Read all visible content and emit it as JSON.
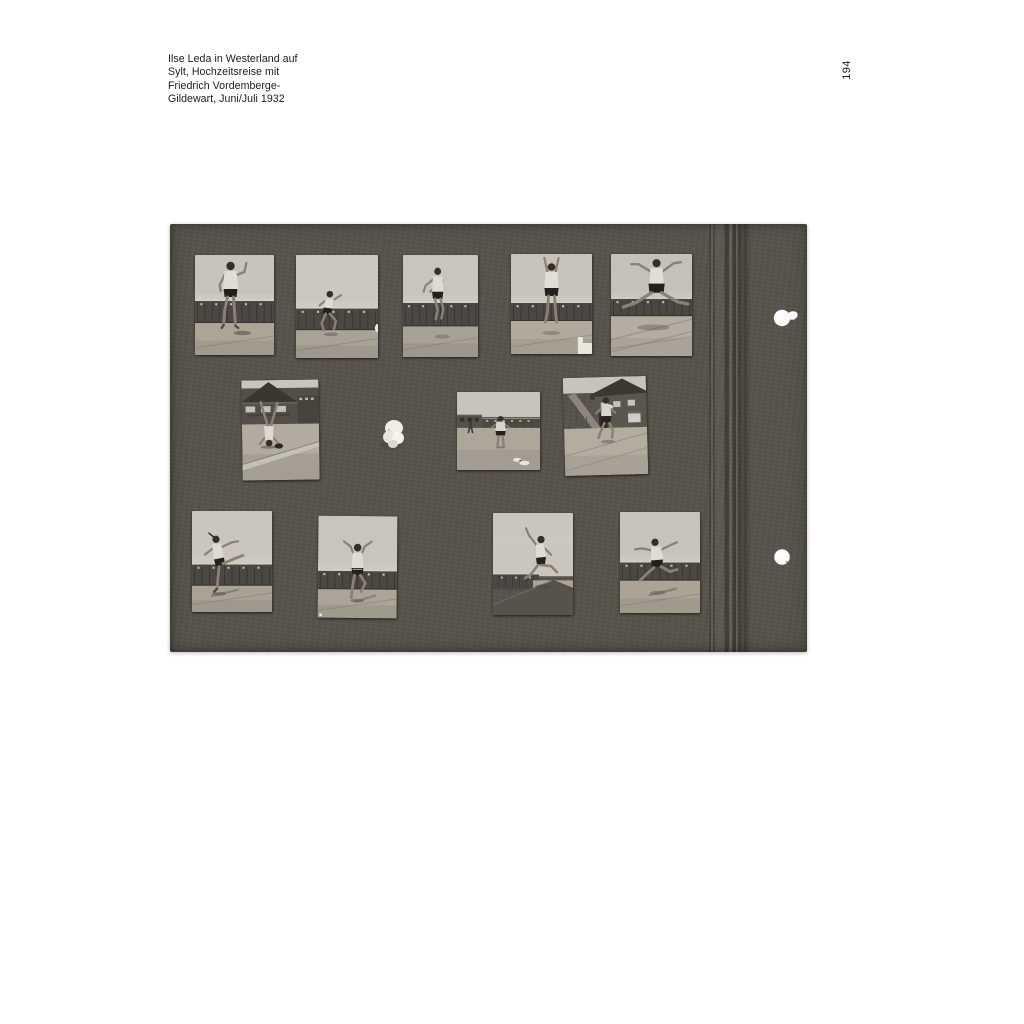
{
  "page": {
    "background": "#ffffff",
    "number": "194"
  },
  "caption": {
    "lines": [
      "Ilse Leda in Westerland auf",
      "Sylt, Hochzeitsreise mit",
      "Friedrich Vordemberge-",
      "Gildewart, Juni/Juli 1932"
    ]
  },
  "album": {
    "board": {
      "x": 170,
      "y": 224,
      "width": 637,
      "height": 428,
      "color": "#57534b"
    },
    "binding": {
      "x": 705,
      "width": 48
    },
    "punch_holes": [
      {
        "cx": 782,
        "cy": 318,
        "r": 8.2,
        "torn_tab": true
      },
      {
        "cx": 782,
        "cy": 557,
        "r": 7.8,
        "torn_tab": false
      }
    ],
    "glue_blob": {
      "cx": 394,
      "cy": 432
    },
    "photos": [
      {
        "id": "1",
        "x": 195,
        "y": 255,
        "width": 79,
        "height": 100,
        "rotation": 0,
        "scene": "cabins",
        "pose": "stand-arm-raised",
        "band": [
          46,
          68
        ],
        "sky": "#c8c4bc",
        "ground_color": "#aca596",
        "description": "Gymnastic pose, one arm raised, beach cabins behind"
      },
      {
        "id": "2",
        "x": 296,
        "y": 255,
        "width": 82,
        "height": 103,
        "rotation": 0,
        "scene": "cabins",
        "pose": "leap",
        "band": [
          52,
          73
        ],
        "sky": "#ccc8c0",
        "ground_color": "#a9a296",
        "description": "Distant leap in front of cabin row"
      },
      {
        "id": "3",
        "x": 403,
        "y": 255,
        "width": 75,
        "height": 102,
        "rotation": 0,
        "scene": "cabins",
        "pose": "jump-forward",
        "band": [
          47,
          70
        ],
        "sky": "#c9c5bd",
        "ground_color": "#a8a195",
        "description": "Mid-air jump before the cabins"
      },
      {
        "id": "4",
        "x": 511,
        "y": 254,
        "width": 81,
        "height": 100,
        "rotation": 0,
        "scene": "cabins",
        "pose": "jump-arms-up",
        "band": [
          49,
          67
        ],
        "sky": "#c7c3bb",
        "ground_color": "#b0a99c",
        "description": "Jump with arms stretched straight up"
      },
      {
        "id": "5",
        "x": 611,
        "y": 254,
        "width": 81,
        "height": 102,
        "rotation": 0,
        "scene": "cabins",
        "pose": "split-leap",
        "band": [
          44,
          61
        ],
        "sky": "#c5c1b9",
        "ground_color": "#b4aea2",
        "description": "Split leap above the cabin roofs"
      },
      {
        "id": "6",
        "x": 242,
        "y": 380,
        "width": 77,
        "height": 100,
        "rotation": -0.8,
        "scene": "building",
        "pose": "headstand",
        "band": [
          44,
          100
        ],
        "sky": "#c9c5bd",
        "ground_color": "#b2ab9f",
        "description": "Headstand in front of the bathhouse"
      },
      {
        "id": "7",
        "x": 457,
        "y": 392,
        "width": 83,
        "height": 78,
        "rotation": 0,
        "scene": "beach",
        "pose": "stand-front",
        "band": [
          30,
          46
        ],
        "sky": "#c8c4bc",
        "ground_color": "#ada79a",
        "description": "Standing on the sand, buildings at the horizon"
      },
      {
        "id": "8",
        "x": 564,
        "y": 377,
        "width": 83,
        "height": 98,
        "rotation": -1.5,
        "scene": "house",
        "pose": "house-jump",
        "band": [
          16,
          52
        ],
        "sky": "#c8c4bc",
        "ground_color": "#b3ada0",
        "description": "Jump in front of a house with slide"
      },
      {
        "id": "9",
        "x": 192,
        "y": 511,
        "width": 80,
        "height": 101,
        "rotation": 0,
        "scene": "cabins",
        "pose": "balance-kick",
        "band": [
          53,
          74
        ],
        "sky": "#cac6be",
        "ground_color": "#a9a295",
        "description": "Balance with one leg kicked high"
      },
      {
        "id": "10",
        "x": 318,
        "y": 516,
        "width": 79,
        "height": 102,
        "rotation": 0.5,
        "scene": "cabins",
        "pose": "dance-arms-up",
        "band": [
          54,
          72
        ],
        "sky": "#c9c5bd",
        "ground_color": "#aba497",
        "description": "Dance pose with both arms raised"
      },
      {
        "id": "11",
        "x": 493,
        "y": 513,
        "width": 80,
        "height": 102,
        "rotation": 0,
        "scene": "wall",
        "pose": "hurdle-leap",
        "band": [
          60,
          75
        ],
        "sky": "#cac6be",
        "ground_color": "#aaa396",
        "description": "Leap over the wall edge"
      },
      {
        "id": "12",
        "x": 620,
        "y": 512,
        "width": 80,
        "height": 101,
        "rotation": 0,
        "scene": "cabins",
        "pose": "run-leap",
        "band": [
          50,
          68
        ],
        "sky": "#c7c3bb",
        "ground_color": "#aba496",
        "description": "Running leap across the promenade"
      }
    ]
  }
}
